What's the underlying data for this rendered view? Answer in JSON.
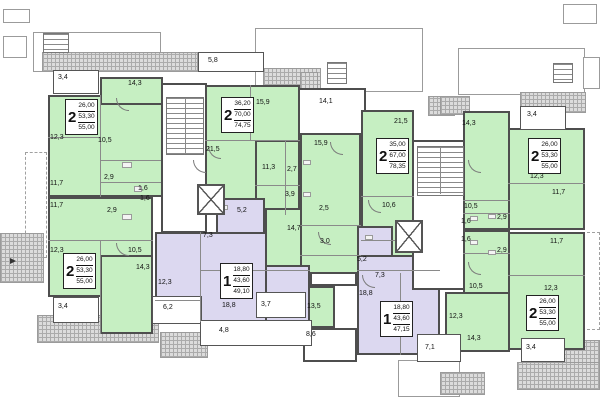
{
  "plan_type": "residential-floor-plan",
  "colors": {
    "apartment_green": "#c6efc2",
    "apartment_purple": "#dcd8f0",
    "roof_hatch": "#dcdcdc",
    "wall": "#4e4e4e"
  },
  "apartments": [
    {
      "rooms_count": "2",
      "area_living": "26,00",
      "area_total": "53,30",
      "area_full": "55,00"
    },
    {
      "rooms_count": "2",
      "area_living": "26,00",
      "area_total": "53,30",
      "area_full": "55,00"
    },
    {
      "rooms_count": "2",
      "area_living": "36,20",
      "area_total": "70,00",
      "area_full": "74,75"
    },
    {
      "rooms_count": "2",
      "area_living": "35,00",
      "area_total": "67,00",
      "area_full": "78,35"
    },
    {
      "rooms_count": "2",
      "area_living": "26,00",
      "area_total": "53,30",
      "area_full": "55,00"
    },
    {
      "rooms_count": "2",
      "area_living": "26,00",
      "area_total": "53,30",
      "area_full": "55,00"
    },
    {
      "rooms_count": "1",
      "area_living": "18,80",
      "area_total": "43,60",
      "area_full": "49,10"
    },
    {
      "rooms_count": "1",
      "area_living": "18,80",
      "area_total": "43,60",
      "area_full": "47,15"
    }
  ],
  "labels": [
    {
      "t": "3,4"
    },
    {
      "t": "14,3"
    },
    {
      "t": "12,3"
    },
    {
      "t": "10,5"
    },
    {
      "t": "11,7"
    },
    {
      "t": "2,9"
    },
    {
      "t": "1,6"
    },
    {
      "t": "11,7"
    },
    {
      "t": "1,6"
    },
    {
      "t": "2,9"
    },
    {
      "t": "12,3"
    },
    {
      "t": "10,5"
    },
    {
      "t": "14,3"
    },
    {
      "t": "3,4"
    },
    {
      "t": "5,8"
    },
    {
      "t": "15,9"
    },
    {
      "t": "21,5"
    },
    {
      "t": "11,3"
    },
    {
      "t": "2,7"
    },
    {
      "t": "3,9"
    },
    {
      "t": "14,1"
    },
    {
      "t": "15,9"
    },
    {
      "t": "2,5"
    },
    {
      "t": "3,0"
    },
    {
      "t": "14,7"
    },
    {
      "t": "21,5"
    },
    {
      "t": "10,6"
    },
    {
      "t": "13,5"
    },
    {
      "t": "8,6"
    },
    {
      "t": "3,4"
    },
    {
      "t": "14,3"
    },
    {
      "t": "12,3"
    },
    {
      "t": "11,7"
    },
    {
      "t": "10,5"
    },
    {
      "t": "1,6"
    },
    {
      "t": "2,9"
    },
    {
      "t": "1,6"
    },
    {
      "t": "2,9"
    },
    {
      "t": "11,7"
    },
    {
      "t": "10,5"
    },
    {
      "t": "12,3"
    },
    {
      "t": "14,3"
    },
    {
      "t": "3,4"
    },
    {
      "t": "7,1"
    },
    {
      "t": "5,2"
    },
    {
      "t": "7,3"
    },
    {
      "t": "12,3"
    },
    {
      "t": "18,8"
    },
    {
      "t": "6,2"
    },
    {
      "t": "3,7"
    },
    {
      "t": "4,8"
    },
    {
      "t": "5,2"
    },
    {
      "t": "7,3"
    },
    {
      "t": "18,8"
    },
    {
      "t": "12,3"
    }
  ]
}
